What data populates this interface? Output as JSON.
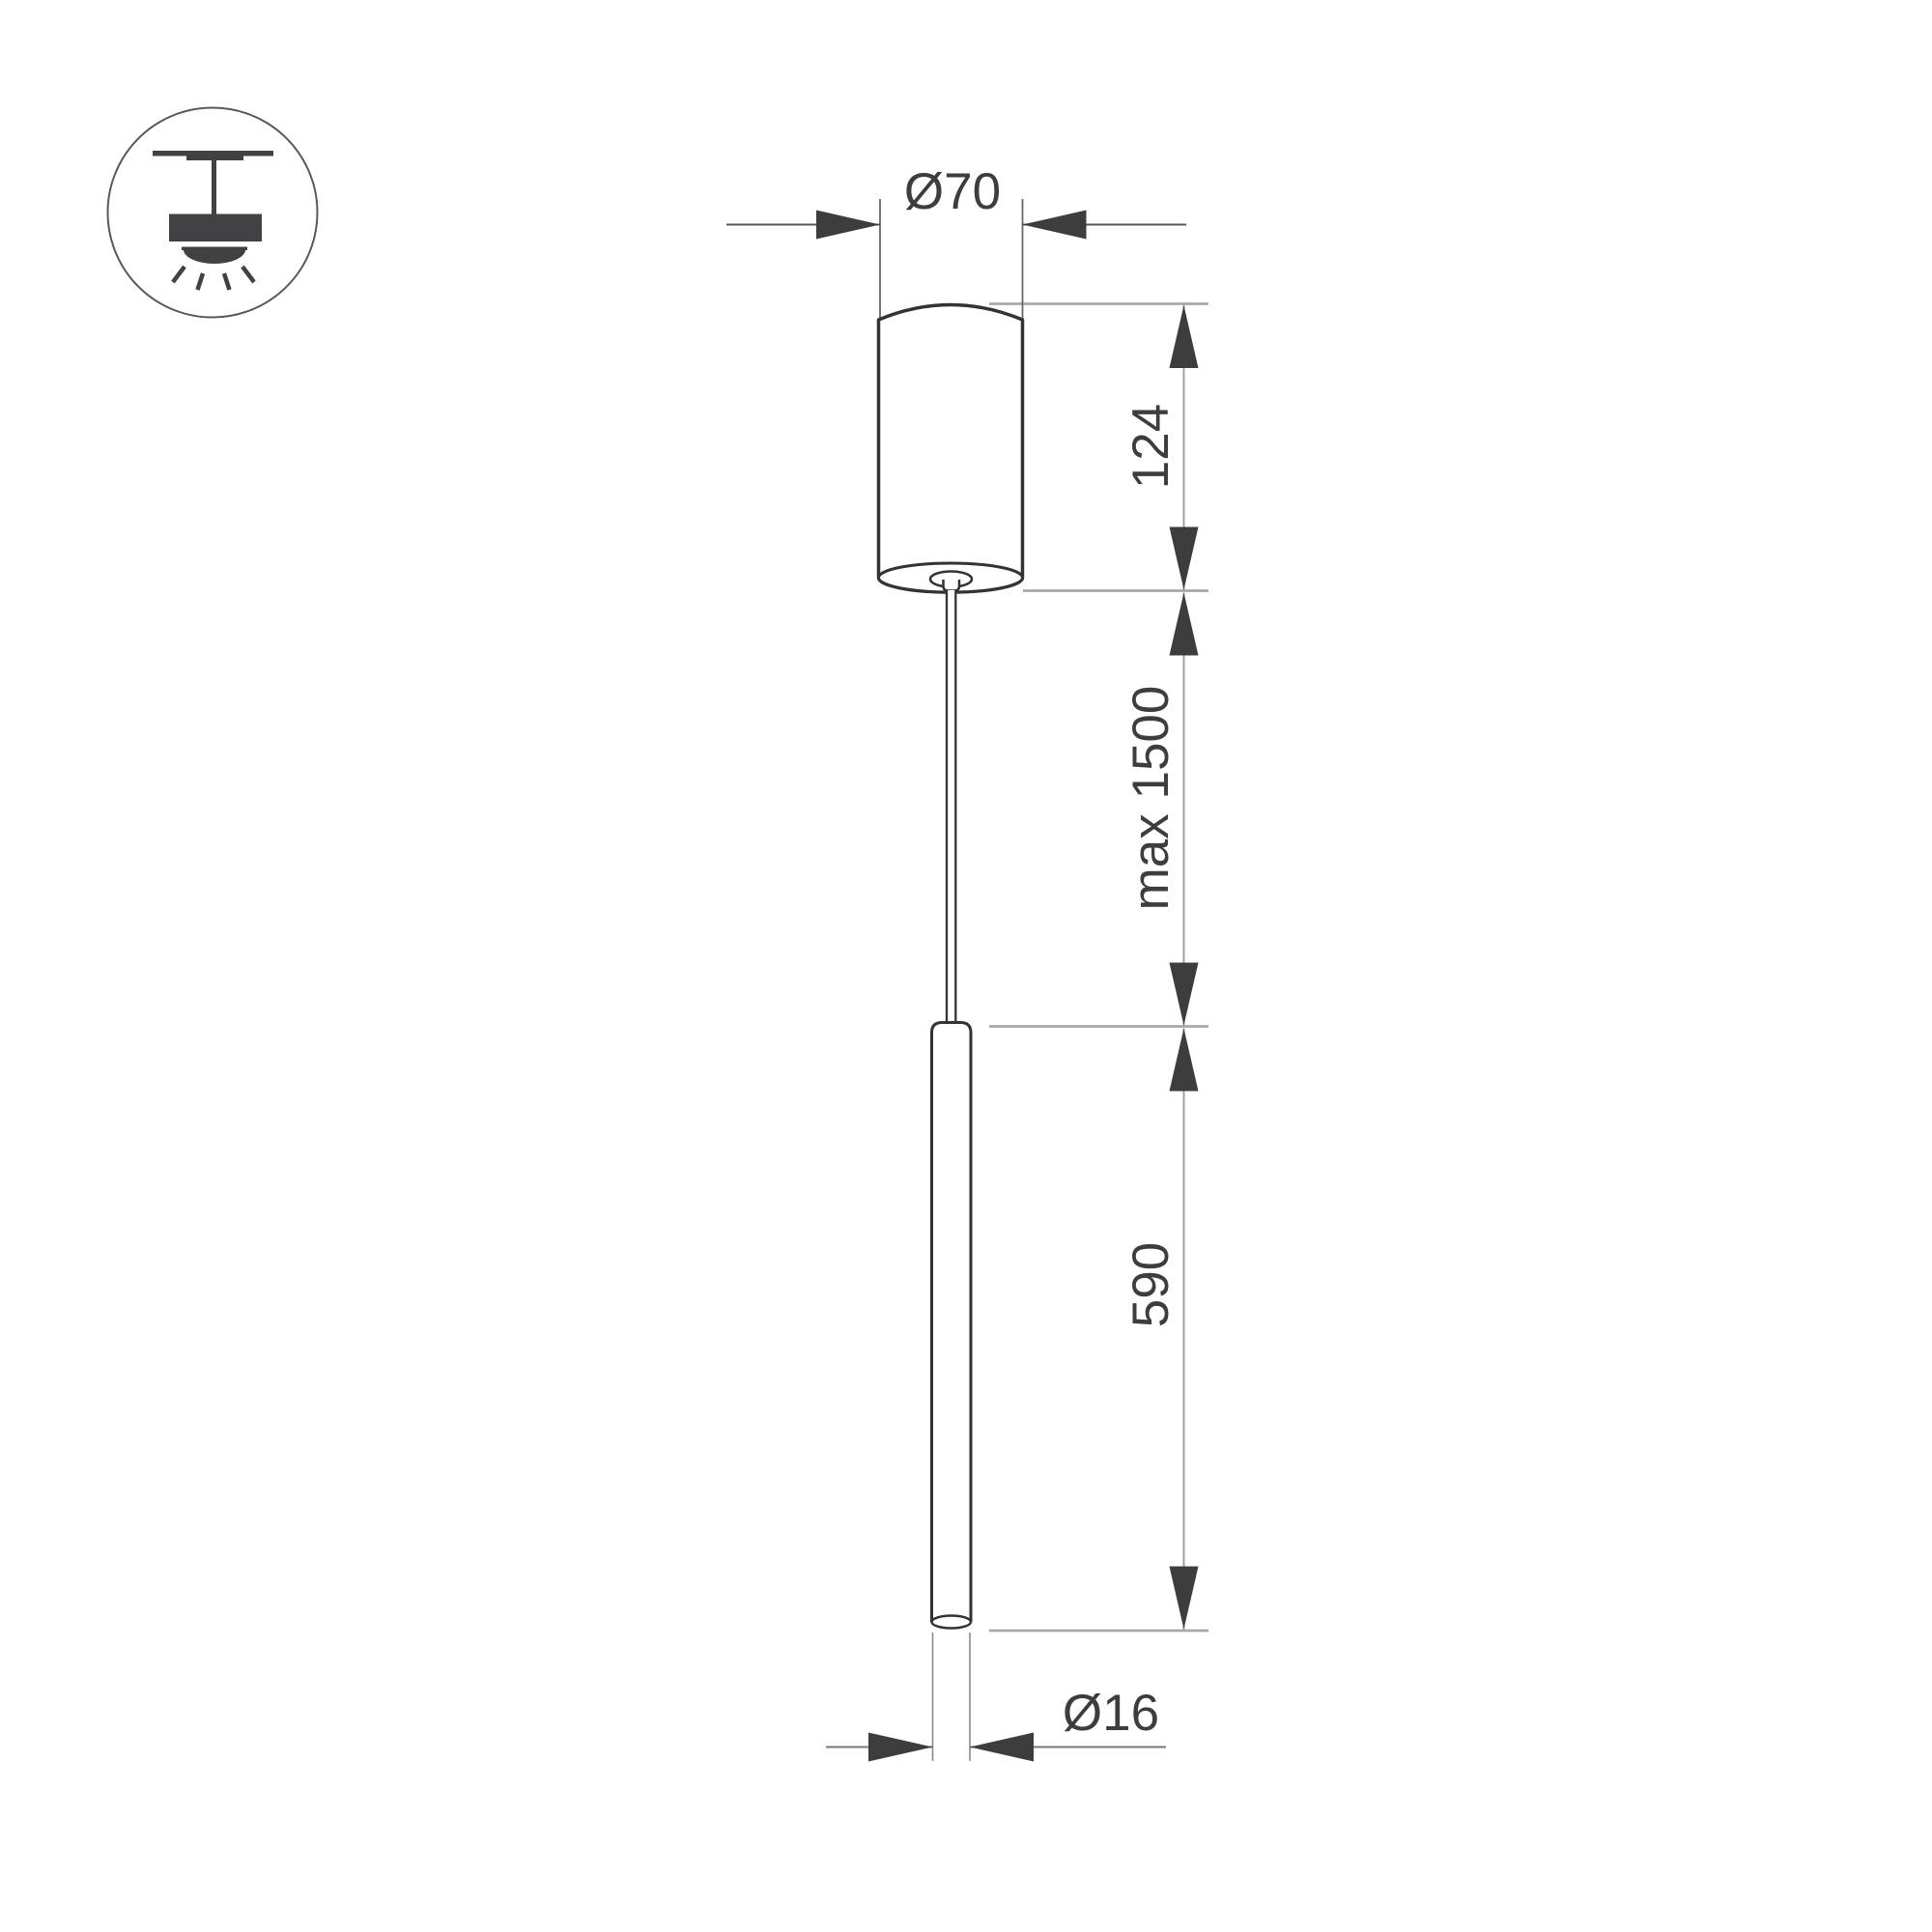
{
  "page": {
    "type": "technical-dimension-drawing",
    "subject": "pendant-lamp",
    "background": "#ffffff"
  },
  "icon": {
    "label": "ceiling-pendant-light"
  },
  "dimensions": {
    "canopy_diameter": "Ø70",
    "canopy_height": "124",
    "suspension_max_length": "max 1500",
    "lamp_tube_length": "590",
    "tube_diameter": "Ø16"
  },
  "colors": {
    "outline_dark": "#333335",
    "dimension_dark": "#3d3d3f",
    "dimension_line_gray": "#98989a",
    "extension_gray": "#a8a8aa",
    "icon_fill": "#414143",
    "background": "#ffffff"
  }
}
